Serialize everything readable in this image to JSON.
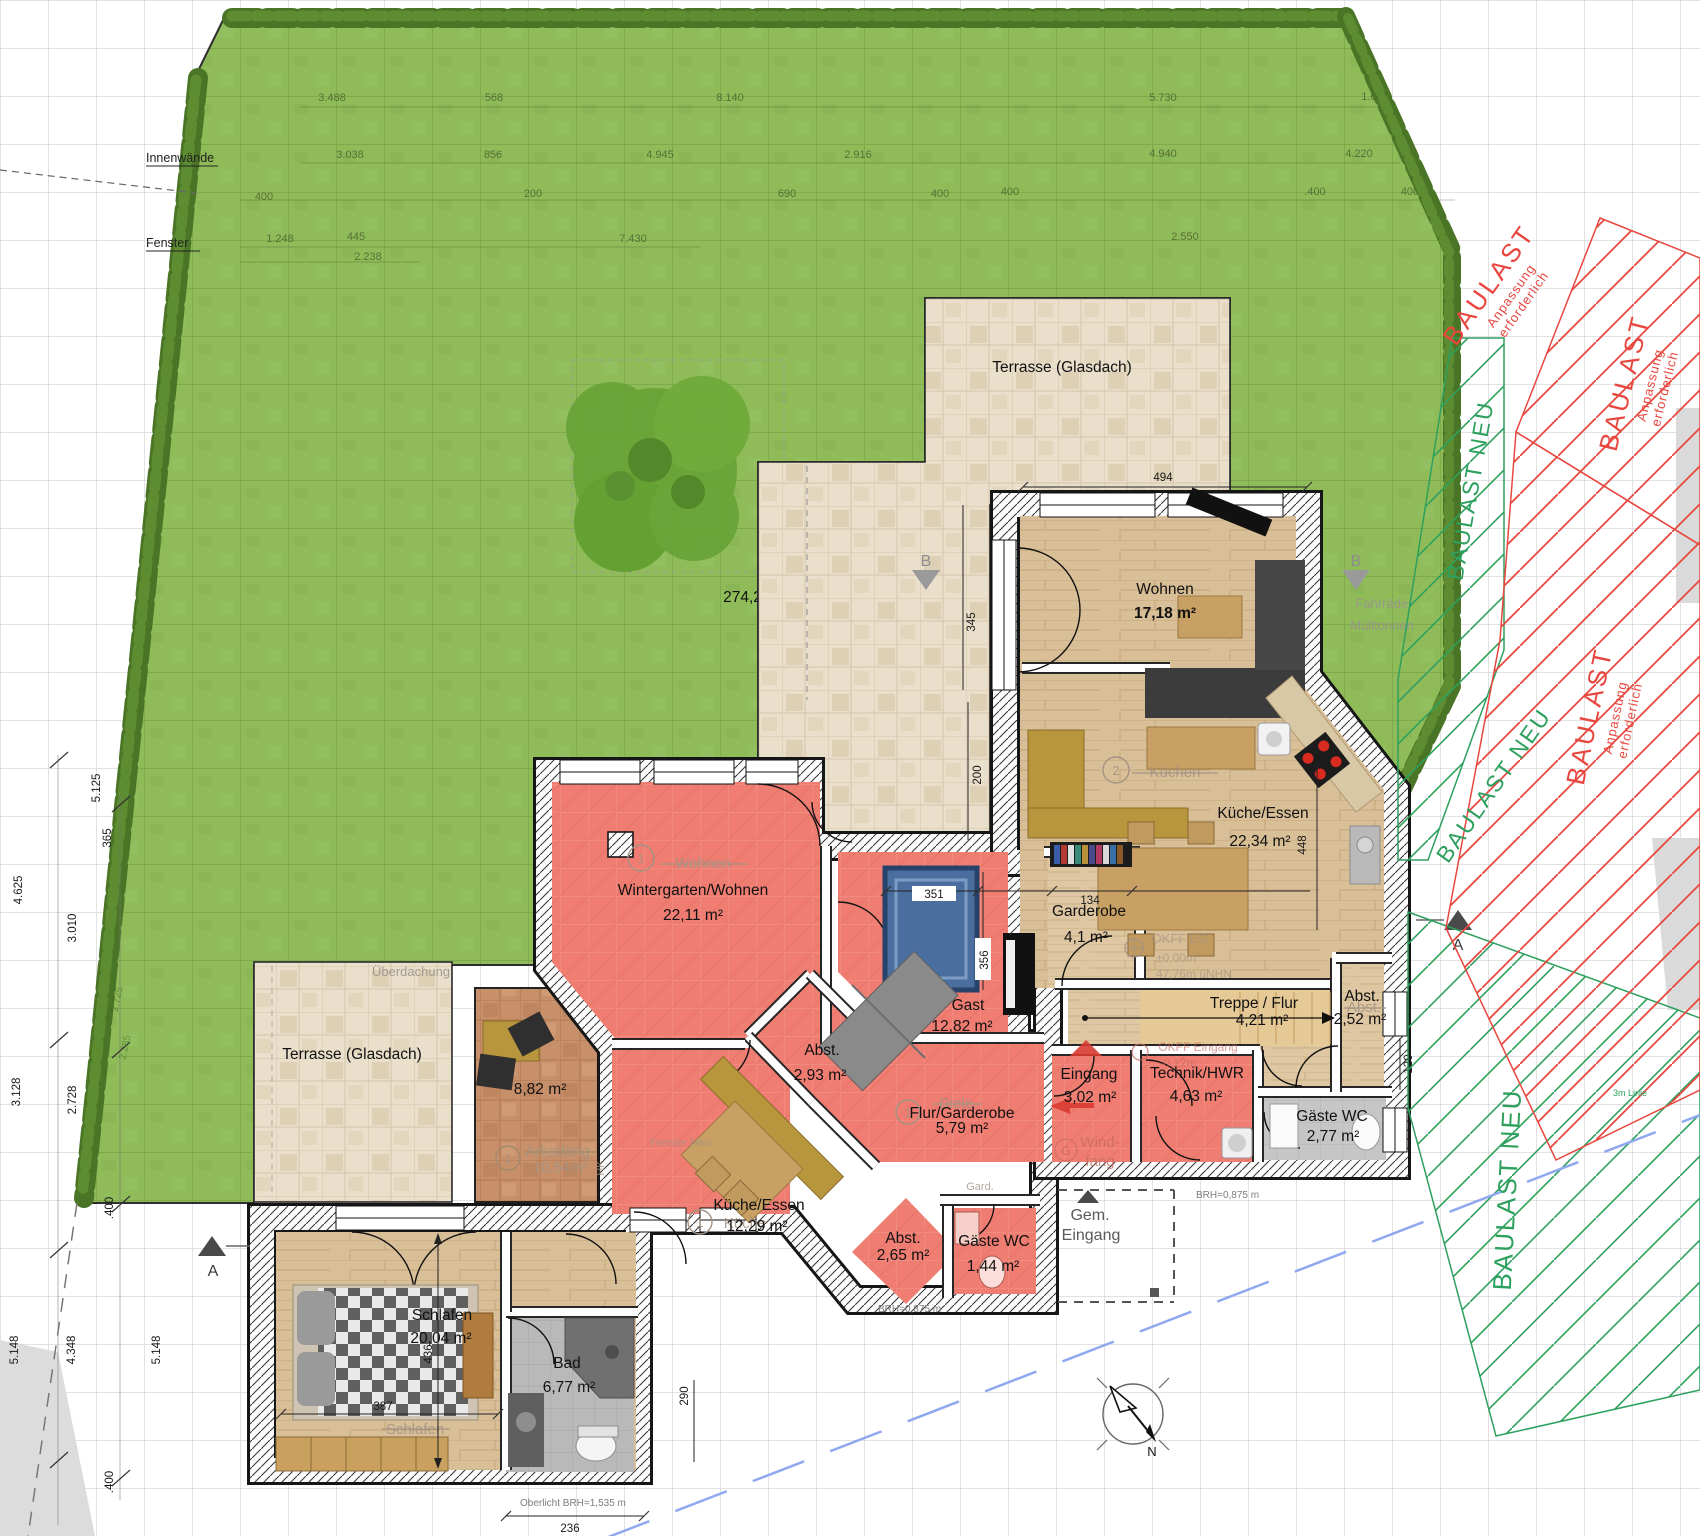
{
  "labels": {
    "terrasse_nord": "Terrasse (Glasdach)",
    "terrasse_west": "Terrasse (Glasdach)",
    "garden_area": "274,26 m²",
    "gem1": "Gem.",
    "gem2": "Eingang",
    "innenwaende": "Innenwände",
    "fenster": "Fenster"
  },
  "rooms": {
    "wohnen": {
      "name": "Wohnen",
      "area": "17,18 m²"
    },
    "kueche_og": {
      "name": "Küche/Essen",
      "area": "22,34 m²"
    },
    "wintergarten": {
      "name": "Wintergarten/Wohnen",
      "area": "22,11 m²"
    },
    "garderobe": {
      "name": "Garderobe",
      "area": "4,1 m²"
    },
    "gast": {
      "name": "Gast",
      "area": "12,82 m²"
    },
    "abst_gast": {
      "name": "Abst.",
      "area": "2,93 m²"
    },
    "treppe": {
      "name": "Treppe / Flur",
      "area": "4,21 m²"
    },
    "abst_treppe": {
      "name": "Abst.",
      "area": "2,52 m²"
    },
    "eingang": {
      "name": "Eingang",
      "area": "3,02 m²"
    },
    "technik": {
      "name": "Technik/HWR",
      "area": "4,63 m²"
    },
    "gaeste_wc_og": {
      "name": "Gäste WC",
      "area": "2,77 m²"
    },
    "flur_garderobe": {
      "name": "Flur/Garderobe",
      "area": "5,79 m²"
    },
    "arkade": {
      "area": "8,82 m²"
    },
    "kueche_elw": {
      "name": "Küche/Essen",
      "area": "12,29 m²"
    },
    "abst_elw": {
      "name": "Abst.",
      "area": "2,65 m²"
    },
    "gaeste_wc_elw": {
      "name": "Gäste WC",
      "area": "1,44 m²"
    },
    "schlafen": {
      "name": "Schlafen",
      "area": "20,04 m²"
    },
    "bad": {
      "name": "Bad",
      "area": "6,77 m²"
    }
  },
  "underlay": {
    "wohnen": "Wohnen",
    "kuechen": "Küchen",
    "kueche": "Küche",
    "diele": "Diele",
    "schlafen": "Schlafen",
    "arkadeng": "Arkadeng.",
    "arkadeng_area": "10,54m²",
    "ueberdachung": "Überdachung",
    "windfang1": "Wind-",
    "windfang2": "fang",
    "abst": "Abst.",
    "gard": "Gard.",
    "fenster_neu": "Fenster Neu",
    "hk": "HK",
    "fahrraeder": "Fahrräder",
    "muelltonnen": "Mülltonnen",
    "okff_eg1": "OKFF EG",
    "okff_eg2": "±0,00m",
    "okff_eg3": "47,76m üNHN",
    "okff_ein1": "OKFF Eingang",
    "okff_ein2": "-0,12m",
    "num1": "1",
    "num2": "2",
    "g": "G"
  },
  "baulast": {
    "red_label": "BAULAST",
    "red_sub1": "Anpassung",
    "red_sub2": "erforderlich",
    "green_label": "BAULAST NEU",
    "linie": "3m Linie"
  },
  "markers": {
    "a": "A",
    "b": "B",
    "n": "N"
  },
  "notes": {
    "brh": "BRH=0,875 m",
    "oberlicht": "Oberlicht BRH=1,535 m"
  },
  "dims": {
    "t1a": "3.488",
    "t1b": "568",
    "t1c": "8.140",
    "t1d": "5.730",
    "t1e": "1.670",
    "t2a": "3.038",
    "t2b": "856",
    "t2c": "4.945",
    "t2d": "2.916",
    "t2e": "4.940",
    "t2f": "4.220",
    "t3a": "400",
    "t3b": "200",
    "t3c": "690",
    "t3d": "400",
    "t3e": "400",
    "t3f": ".400",
    "t3g": "400",
    "t4a": "1.248",
    "t4b": "445",
    "t4c": "7.430",
    "t4d": "2.550",
    "t5a": "2.238",
    "l1": "4.625",
    "l2": "3.010",
    "l3": "365",
    "l4": "5.125",
    "l5": "3.128",
    "l6": "2.728",
    "l7": ".400",
    "l8": "5.148",
    "l9": "4.348",
    "l10": "5.148",
    "l11": ".400",
    "g1": "2.285",
    "g2": "2.725",
    "h494": "494",
    "h345": "345",
    "h200": "200",
    "h448": "448",
    "h134": "134",
    "h351": "351",
    "h356": "356",
    "h387": "387",
    "h436": "436",
    "h290": "290",
    "h236": "236",
    "h120": "120"
  }
}
